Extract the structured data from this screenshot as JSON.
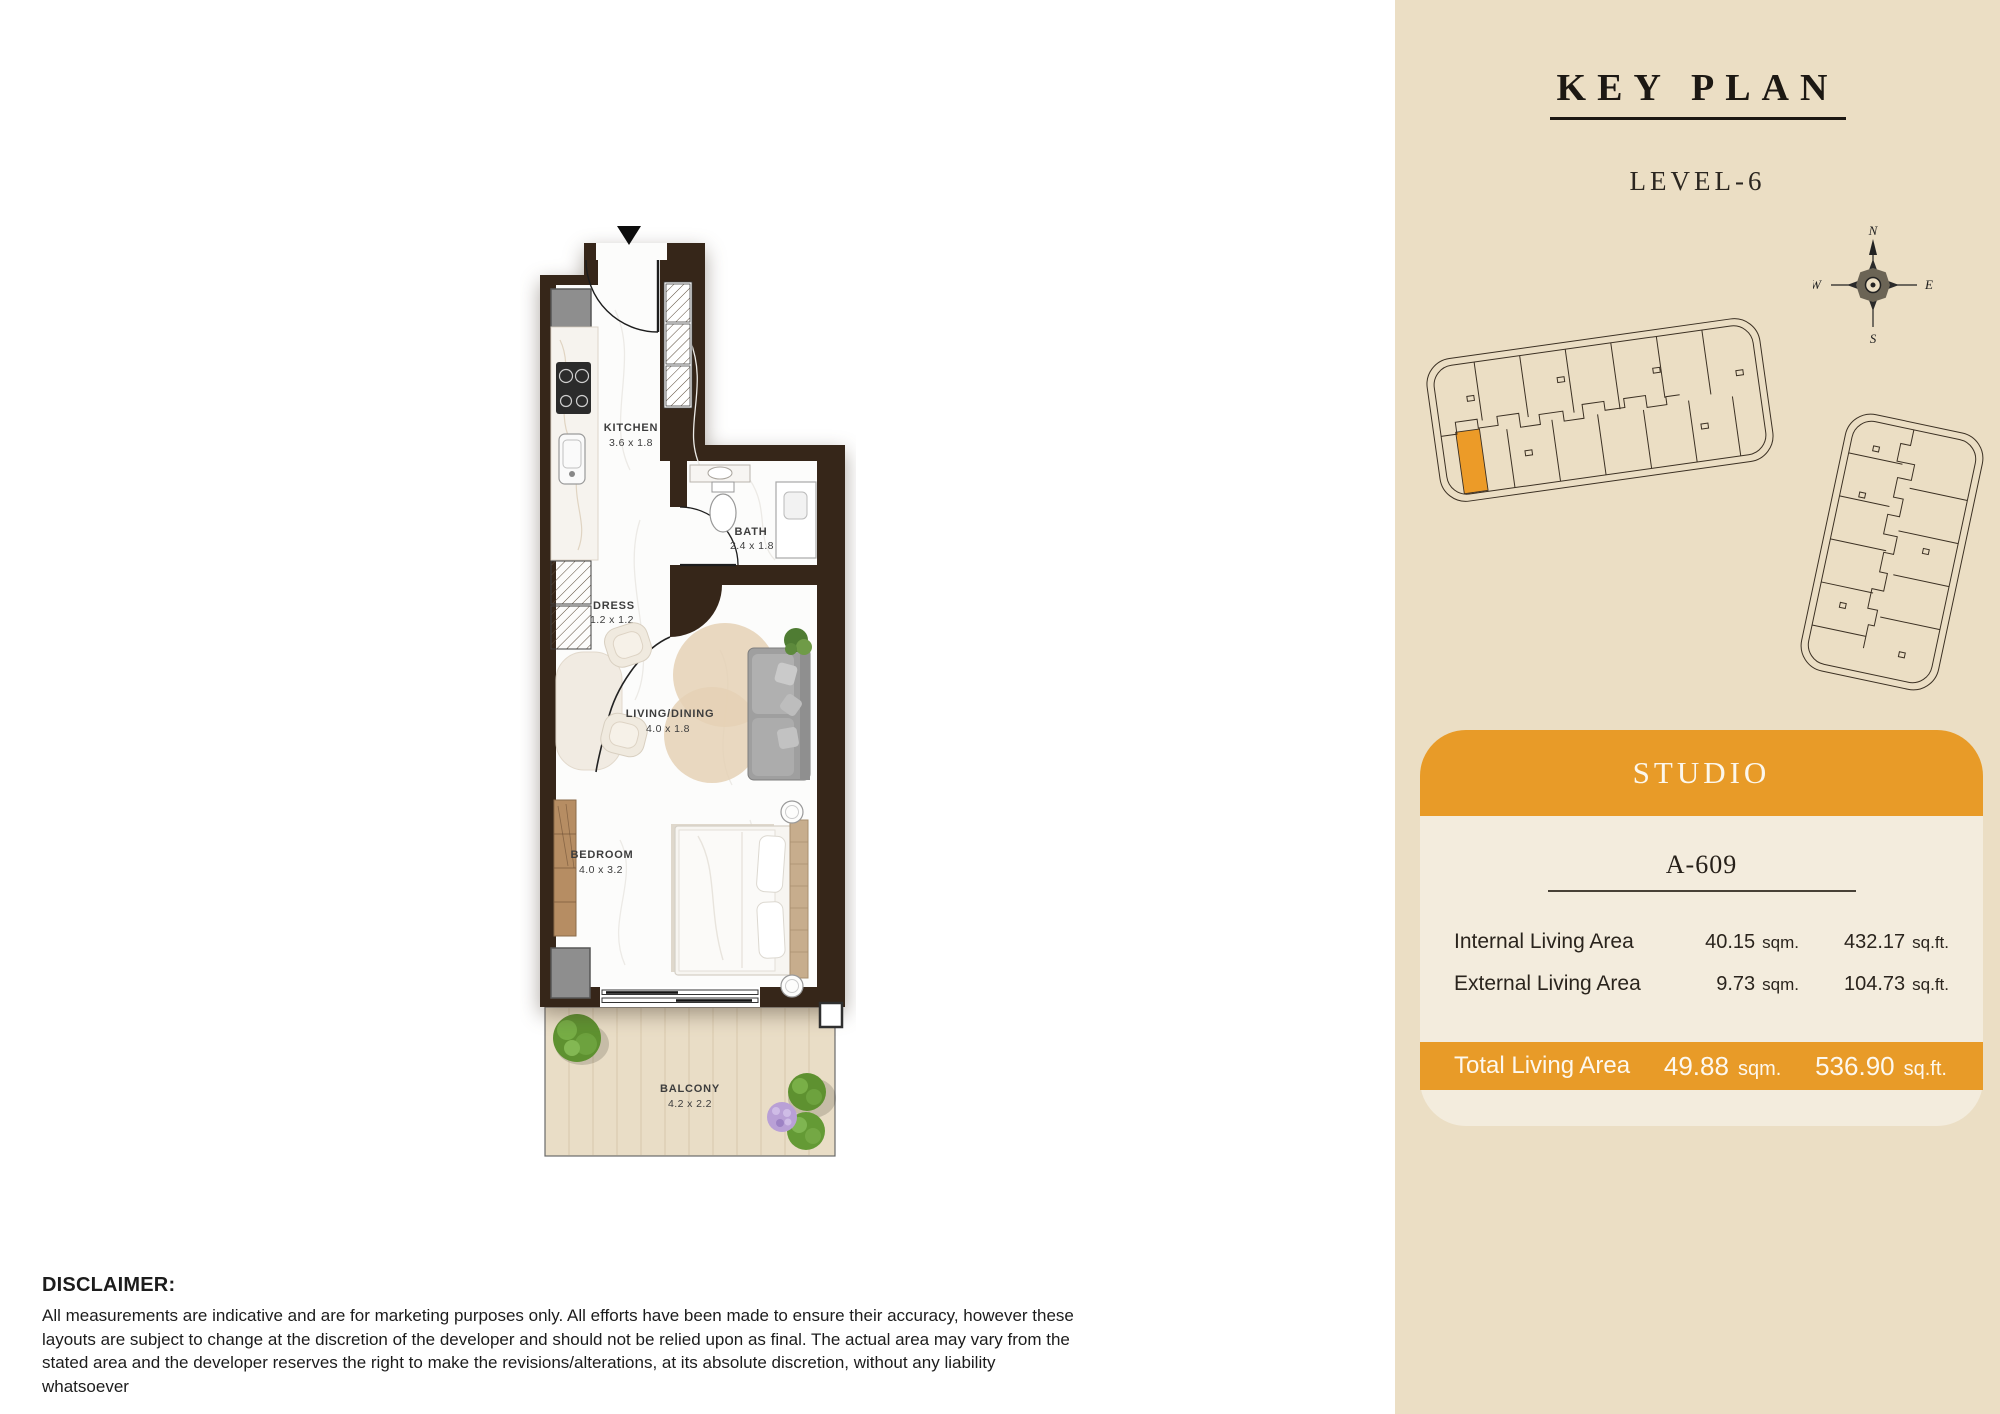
{
  "key_plan": {
    "title": "KEY PLAN",
    "level": "LEVEL-6",
    "compass": {
      "north": "N",
      "east": "E",
      "south": "S",
      "west": "W"
    }
  },
  "floor_plan": {
    "rooms": [
      {
        "name": "KITCHEN",
        "dims": "3.6 x 1.8"
      },
      {
        "name": "BATH",
        "dims": "2.4 x 1.8"
      },
      {
        "name": "DRESS",
        "dims": "1.2 x 1.2"
      },
      {
        "name": "LIVING/DINING",
        "dims": "4.0 x 1.8"
      },
      {
        "name": "BEDROOM",
        "dims": "4.0 x 3.2"
      },
      {
        "name": "BALCONY",
        "dims": "4.2 x 2.2"
      }
    ]
  },
  "unit_card": {
    "type_label": "STUDIO",
    "unit_number": "A-609",
    "rows": [
      {
        "label": "Internal Living Area",
        "sqm": "40.15",
        "sqm_unit": "sqm.",
        "sqft": "432.17",
        "sqft_unit": "sq.ft."
      },
      {
        "label": "External Living Area",
        "sqm": "9.73",
        "sqm_unit": "sqm.",
        "sqft": "104.73",
        "sqft_unit": "sq.ft."
      }
    ],
    "total": {
      "label": "Total Living Area",
      "sqm": "49.88",
      "sqm_unit": "sqm.",
      "sqft": "536.90",
      "sqft_unit": "sq.ft."
    }
  },
  "disclaimer": {
    "title": "DISCLAIMER:",
    "body": "All measurements are indicative and are for marketing purposes only. All efforts have been made to ensure their accuracy, however these layouts are subject to change at the discretion of the developer and should not be relied upon as final. The actual area may vary from the stated area and the developer reserves the right to make the revisions/alterations, at its absolute discretion, without any liability whatsoever"
  },
  "colors": {
    "accent_orange": "#e89b28",
    "panel_bg": "#ebdec4",
    "card_bg": "#f3ecdd",
    "wall_brown": "#362619"
  }
}
